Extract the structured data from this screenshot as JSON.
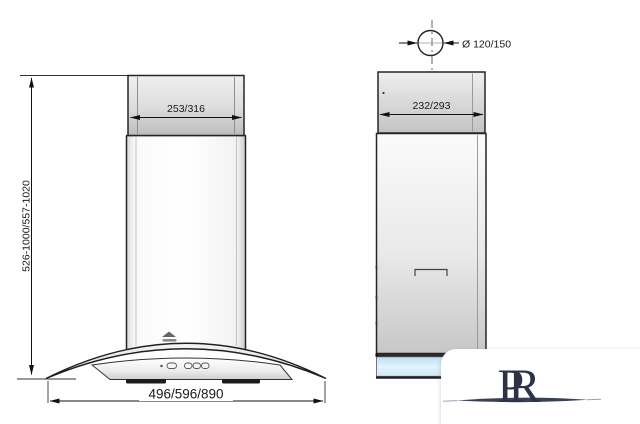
{
  "drawing": {
    "front_view": {
      "chimney_width_label": "253/316",
      "height_range_label": "526-1000/557-1020",
      "overall_width_label": "496/596/890"
    },
    "side_view": {
      "depth_label": "232/293",
      "duct_diameter_label": "Ø 120/150"
    },
    "watermark": {
      "letter_p": "P",
      "letter_r": "R"
    },
    "colors": {
      "line": "#222222",
      "glass_blue": "#cde8f5",
      "logo_navy": "#2c3347"
    }
  }
}
